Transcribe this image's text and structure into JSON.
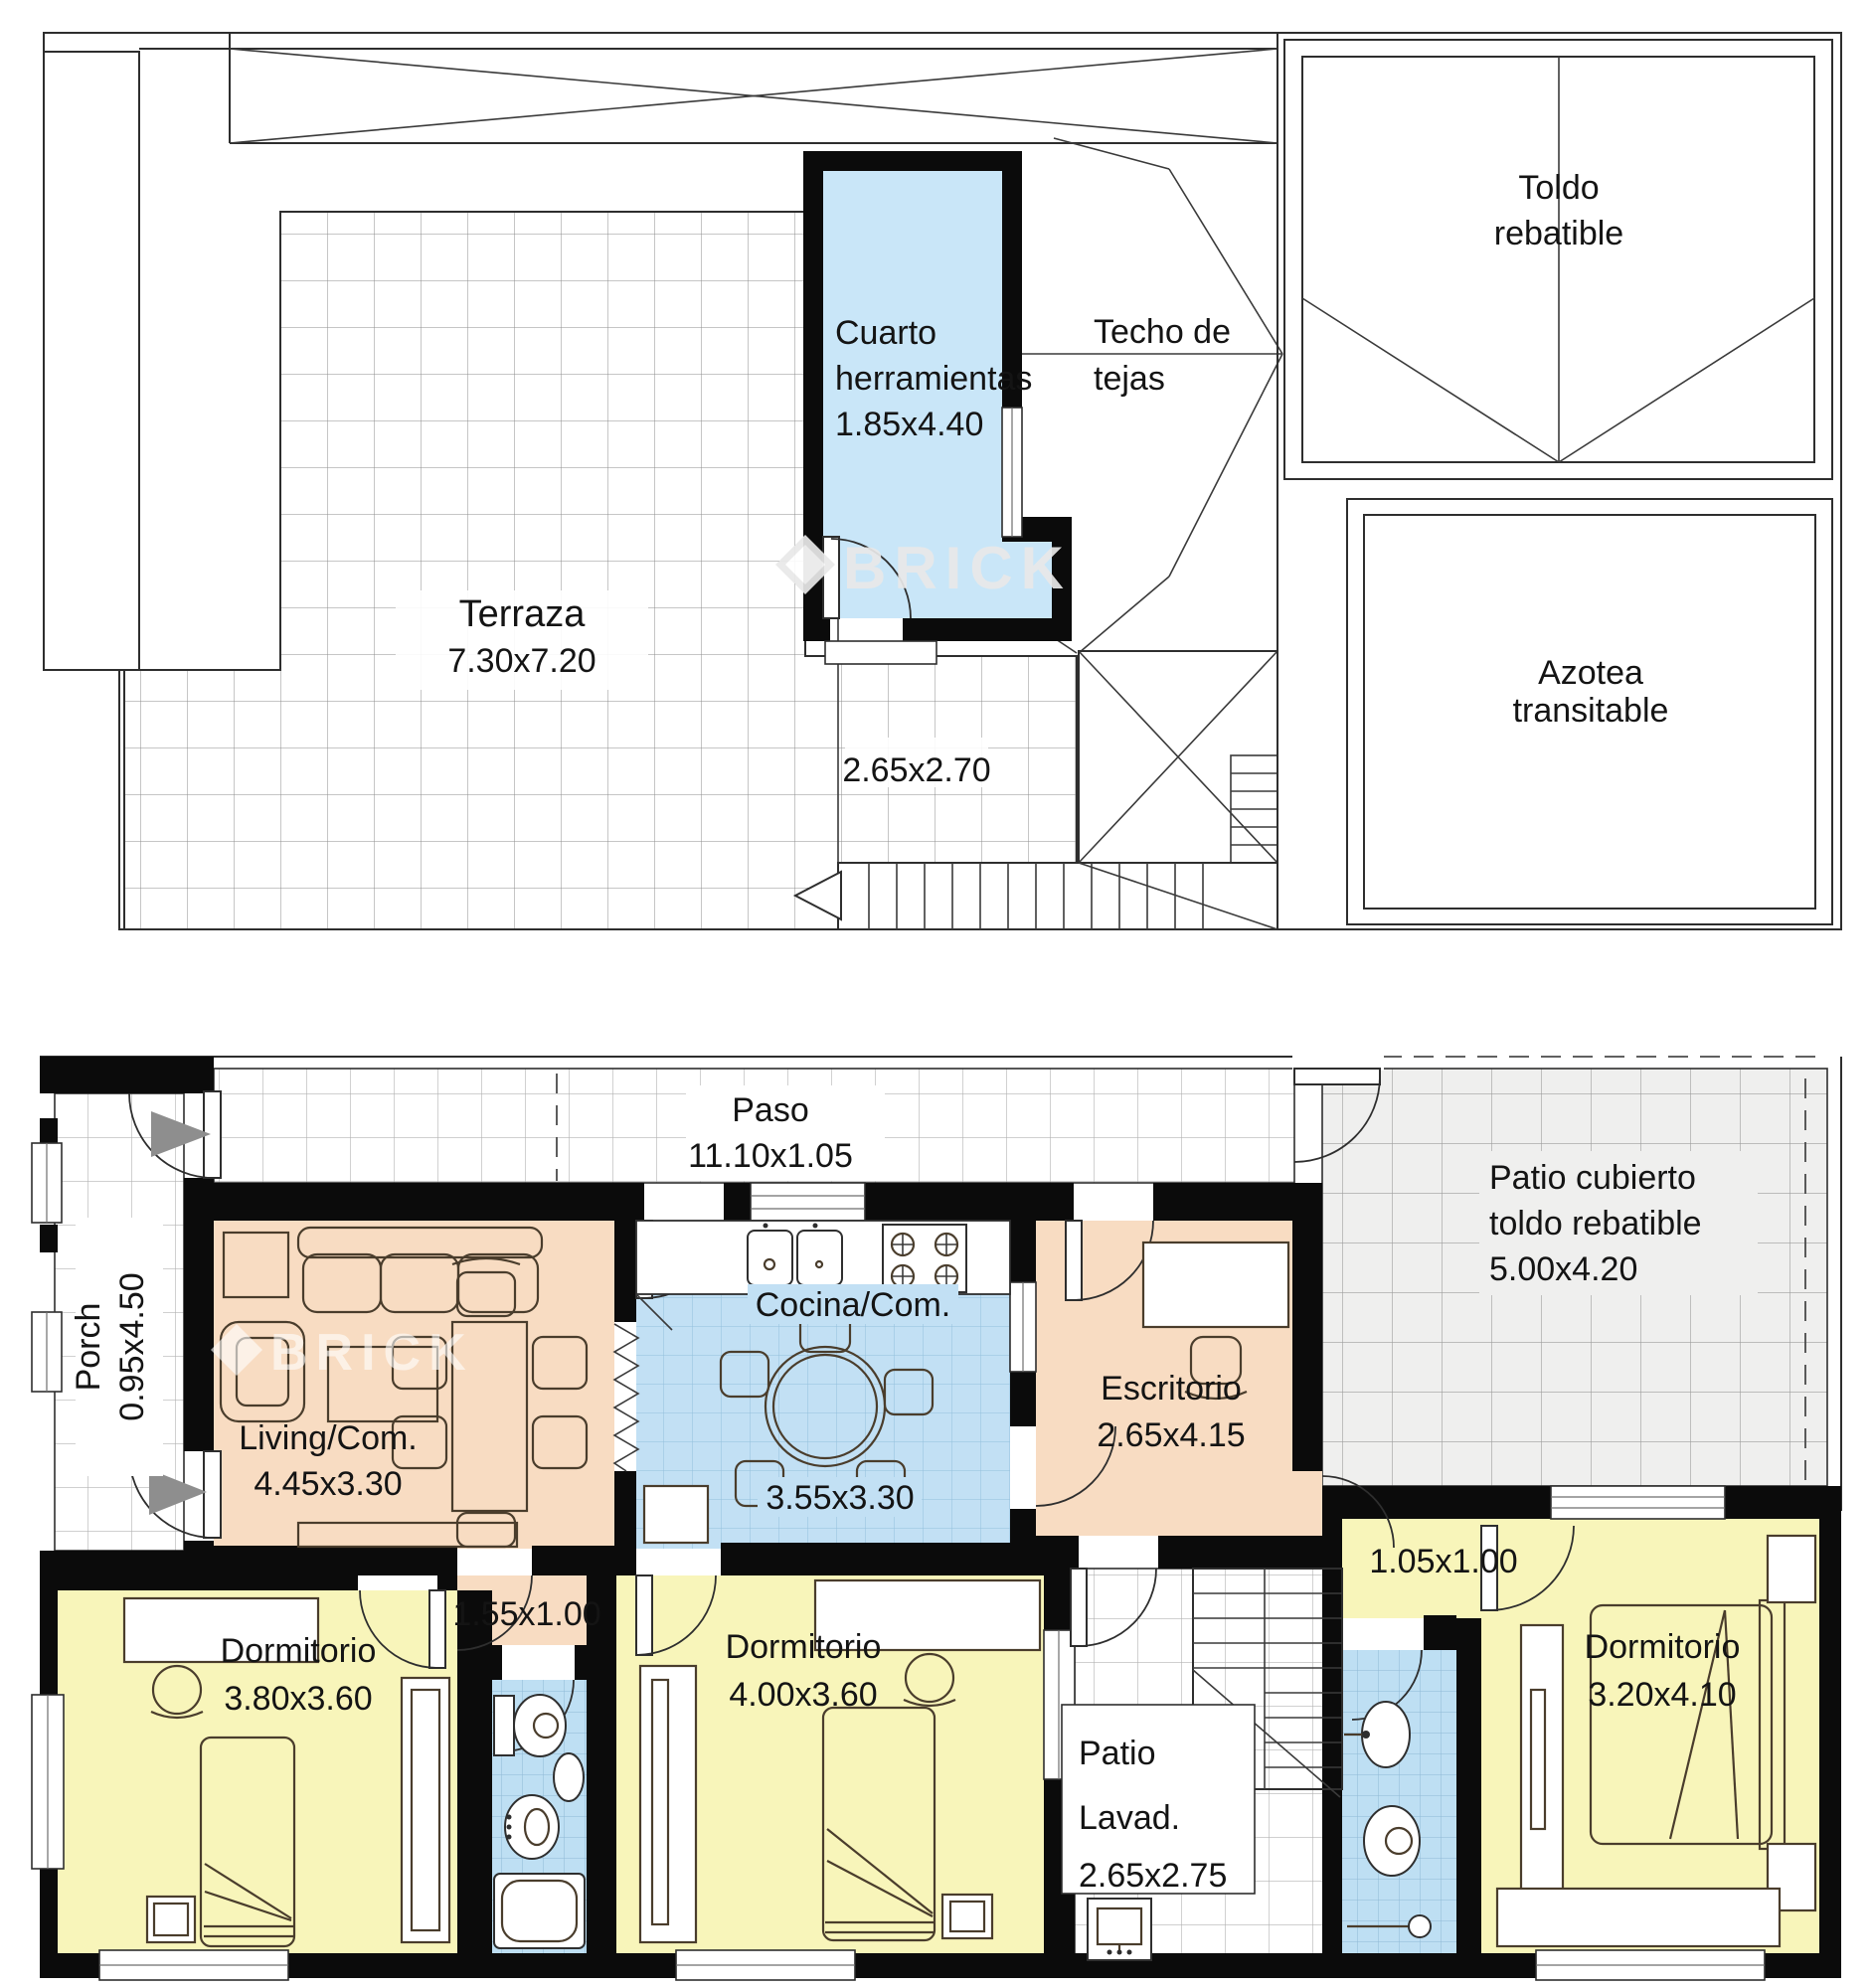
{
  "document": {
    "type": "architectural floor plan",
    "language": "es"
  },
  "watermark": {
    "brand": "BRICK"
  },
  "colors": {
    "wall": "#0b0b0b",
    "room_orange": "#f8dcc2",
    "room_yellow": "#f8f5ba",
    "room_blue": "#c2e0f4",
    "room_blue_plain": "#c9e6f8",
    "tile_gray": "#efefee",
    "entry_arrow_gray": "#8e8e8e"
  },
  "upper_plan": {
    "terraza": {
      "name": "Terraza",
      "dims": "7.30x7.20"
    },
    "patio_dims": "2.65x2.70",
    "cuarto": {
      "line1": "Cuarto",
      "line2": "herramientas",
      "dims": "1.85x4.40"
    },
    "techo": {
      "line1": "Techo de",
      "line2": "tejas"
    },
    "toldo": {
      "line1": "Toldo",
      "line2": "rebatible"
    },
    "azotea": {
      "line1": "Azotea",
      "line2": "transitable"
    }
  },
  "lower_plan": {
    "paso": {
      "name": "Paso",
      "dims": "11.10x1.05"
    },
    "porch": {
      "name": "Porch",
      "dims": "0.95x4.50"
    },
    "living": {
      "name": "Living/Com.",
      "dims": "4.45x3.30"
    },
    "cocina": {
      "name": "Cocina/Com.",
      "dims": "3.55x3.30"
    },
    "escritorio": {
      "name": "Escritorio",
      "dims": "2.65x4.15"
    },
    "patio_cubierto": {
      "line1": "Patio cubierto",
      "line2": "toldo rebatible",
      "dims": "5.00x4.20"
    },
    "hall": {
      "dims": "1.55x1.00"
    },
    "hall2": {
      "dims": "1.05x1.00"
    },
    "dorm1": {
      "name": "Dormitorio",
      "dims": "3.80x3.60"
    },
    "dorm2": {
      "name": "Dormitorio",
      "dims": "4.00x3.60"
    },
    "dorm3": {
      "name": "Dormitorio",
      "dims": "3.20x4.10"
    },
    "patio_lavadero": {
      "line1": "Patio",
      "line2": "Lavad.",
      "dims": "2.65x2.75"
    }
  }
}
